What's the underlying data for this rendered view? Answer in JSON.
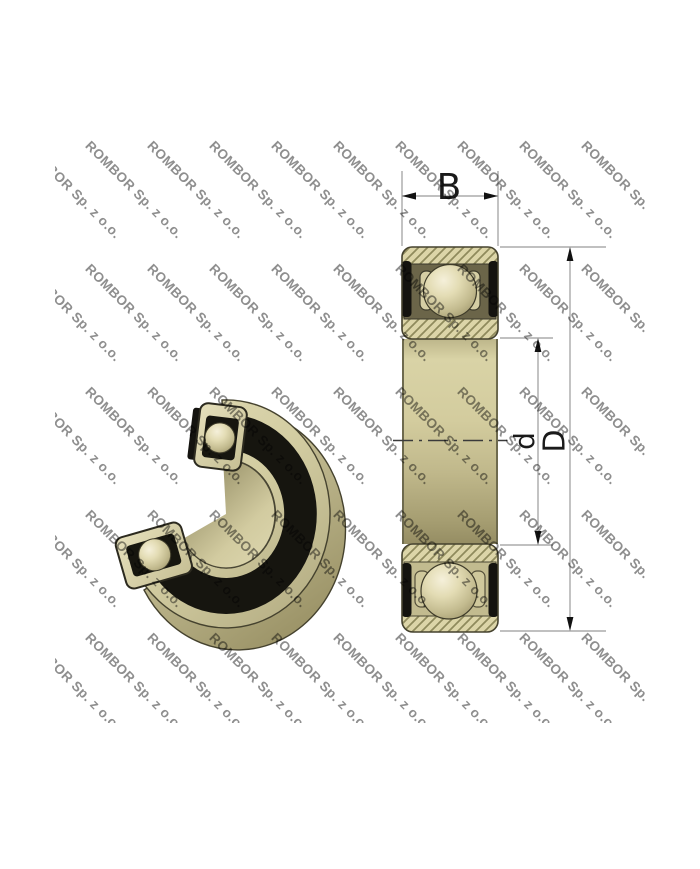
{
  "watermark": {
    "text": "ROMBOR Sp. z o.o."
  },
  "dimensions": {
    "width_label": "B",
    "bore_diameter_label": "d",
    "outer_diameter_label": "D"
  },
  "colors": {
    "background": "#ffffff",
    "watermark_gray": "#8e8e8e",
    "bearing_tan": "#dcd5a8",
    "bearing_dark_olive": "#6b6549",
    "seal_black": "#14130f",
    "hatch_olive": "#8f8a5c",
    "dimension_line_gray": "#9b9b9b",
    "label_black": "#1a1a1a"
  }
}
